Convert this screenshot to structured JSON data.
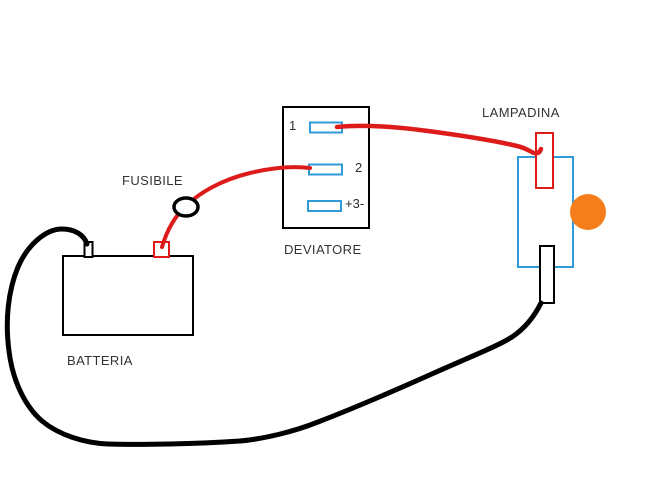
{
  "diagram": {
    "type": "hand-drawn electrical wiring diagram",
    "labels": {
      "battery": "BATTERIA",
      "fuse": "FUSIBILE",
      "switch": "DEVIATORE",
      "lamp": "LAMPADINA",
      "switch_terminal_1": "1",
      "switch_terminal_2": "2",
      "switch_terminal_3": "+3-"
    },
    "colors": {
      "background": "#ffffff",
      "positive_wire": "#dd1b1b",
      "negative_wire": "#000000",
      "component_outline": "#000000",
      "terminal_blue": "#2f9bd8",
      "lamp_body_outline": "#2f9bd8",
      "bulb_fill": "#f57d1a",
      "label_text": "#333333"
    }
  }
}
